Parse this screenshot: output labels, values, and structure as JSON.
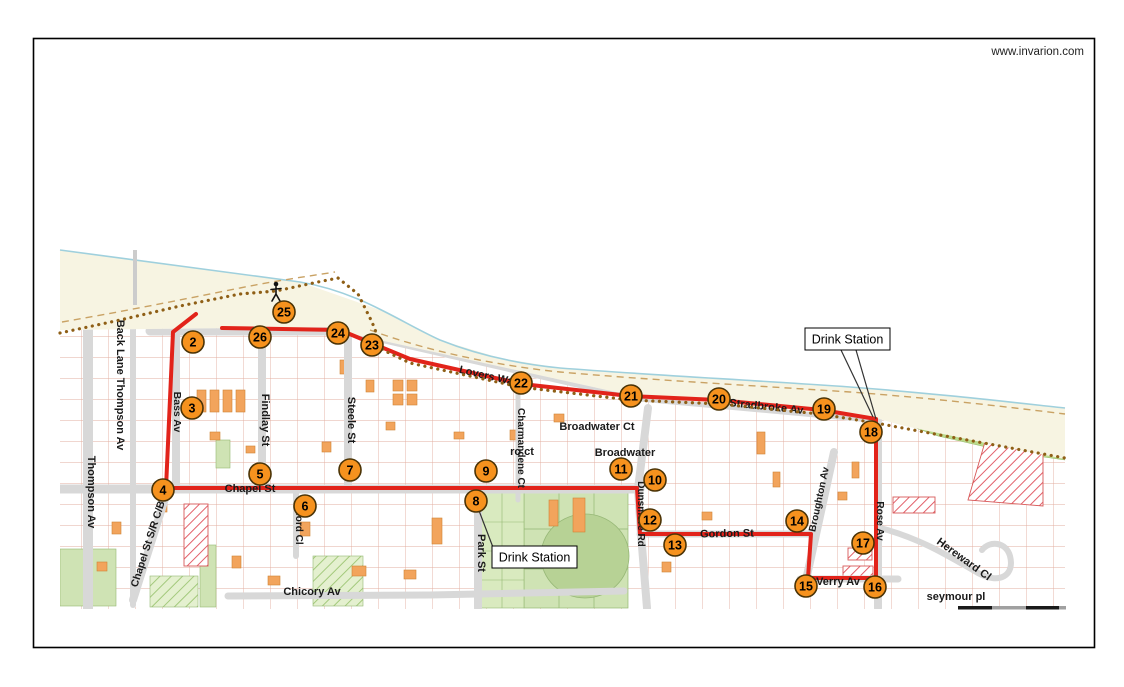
{
  "page": {
    "watermark": "www.invarion.com"
  },
  "colors": {
    "route": "#e2231a",
    "marker_fill": "#f6921e",
    "marker_ring": "#4a3306",
    "street": "#d8d8d8",
    "beach": "#f7f4e2",
    "coast_line": "#9fd0dd",
    "dune_line": "#c9a264",
    "trail": "#8f5f16",
    "green": "#cfe3b4",
    "green_band": "#bcdb8d",
    "oval": "#b7d295"
  },
  "map": {
    "markers": [
      {
        "n": "2",
        "x": 193,
        "y": 342
      },
      {
        "n": "3",
        "x": 192,
        "y": 408
      },
      {
        "n": "4",
        "x": 163,
        "y": 490
      },
      {
        "n": "5",
        "x": 260,
        "y": 474
      },
      {
        "n": "6",
        "x": 305,
        "y": 506
      },
      {
        "n": "7",
        "x": 350,
        "y": 470
      },
      {
        "n": "8",
        "x": 476,
        "y": 501
      },
      {
        "n": "9",
        "x": 486,
        "y": 471
      },
      {
        "n": "10",
        "x": 655,
        "y": 480
      },
      {
        "n": "11",
        "x": 621,
        "y": 469
      },
      {
        "n": "12",
        "x": 650,
        "y": 520
      },
      {
        "n": "13",
        "x": 675,
        "y": 545
      },
      {
        "n": "14",
        "x": 797,
        "y": 521
      },
      {
        "n": "15",
        "x": 806,
        "y": 586
      },
      {
        "n": "16",
        "x": 875,
        "y": 587
      },
      {
        "n": "17",
        "x": 863,
        "y": 543
      },
      {
        "n": "18",
        "x": 871,
        "y": 432
      },
      {
        "n": "19",
        "x": 824,
        "y": 409
      },
      {
        "n": "20",
        "x": 719,
        "y": 399
      },
      {
        "n": "21",
        "x": 631,
        "y": 396
      },
      {
        "n": "22",
        "x": 521,
        "y": 383
      },
      {
        "n": "23",
        "x": 372,
        "y": 345
      },
      {
        "n": "24",
        "x": 338,
        "y": 333
      },
      {
        "n": "25",
        "x": 284,
        "y": 312
      },
      {
        "n": "26",
        "x": 260,
        "y": 337
      }
    ],
    "street_labels": [
      {
        "slug": "back-lane-thompson-av",
        "text": "Back Lane Thompson Av",
        "x": 117,
        "y": 385,
        "rot": 90,
        "size": 11
      },
      {
        "slug": "thompson-av",
        "text": "Thompson Av",
        "x": 88,
        "y": 492,
        "rot": 90,
        "size": 11
      },
      {
        "slug": "bass-av",
        "text": "Bass Av",
        "x": 174,
        "y": 412,
        "rot": 90,
        "size": 10.5
      },
      {
        "slug": "findlay-st",
        "text": "Findlay St",
        "x": 262,
        "y": 420,
        "rot": 90,
        "size": 11
      },
      {
        "slug": "steele-st",
        "text": "Steele St",
        "x": 348,
        "y": 420,
        "rot": 90,
        "size": 11
      },
      {
        "slug": "chapel-st-srcb",
        "text": "Chapel St S/R C/B",
        "x": 151,
        "y": 545,
        "rot": -72,
        "size": 10.5
      },
      {
        "slug": "elsford-cl",
        "text": "Elsford Cl",
        "x": 296,
        "y": 521,
        "rot": 90,
        "size": 10
      },
      {
        "slug": "chapel-st",
        "text": "Chapel St",
        "x": 250,
        "y": 492,
        "rot": 0,
        "size": 11
      },
      {
        "slug": "chicory-av",
        "text": "Chicory Av",
        "x": 312,
        "y": 595,
        "rot": 0,
        "size": 11
      },
      {
        "slug": "park-st",
        "text": "Park St",
        "x": 478,
        "y": 553,
        "rot": 90,
        "size": 11
      },
      {
        "slug": "charmandene-ct",
        "text": "Charmandene Ct",
        "x": 518,
        "y": 448,
        "rot": 90,
        "size": 10
      },
      {
        "slug": "ro-ct",
        "text": "ro ct",
        "x": 522,
        "y": 455,
        "rot": 0,
        "size": 11
      },
      {
        "slug": "broadwater-ct",
        "text": "Broadwater Ct",
        "x": 597,
        "y": 430,
        "rot": 0,
        "size": 11
      },
      {
        "slug": "broadwater",
        "text": "Broadwater",
        "x": 625,
        "y": 456,
        "rot": 0,
        "size": 11
      },
      {
        "slug": "dunsmore-rd",
        "text": "Dunsmore Rd",
        "x": 638,
        "y": 514,
        "rot": 90,
        "size": 10
      },
      {
        "slug": "gordon-st",
        "text": "Gordon St",
        "x": 727,
        "y": 537,
        "rot": -1,
        "size": 11
      },
      {
        "slug": "broughton-av",
        "text": "Broughton Av",
        "x": 822,
        "y": 500,
        "rot": -78,
        "size": 10
      },
      {
        "slug": "verry-av",
        "text": "Verry Av",
        "x": 838,
        "y": 585,
        "rot": 0,
        "size": 11
      },
      {
        "slug": "rose-av",
        "text": "Rose Av",
        "x": 877,
        "y": 521,
        "rot": 90,
        "size": 10
      },
      {
        "slug": "stradbroke-av",
        "text": "Stradbroke Av",
        "x": 766,
        "y": 410,
        "rot": 6,
        "size": 11
      },
      {
        "slug": "lovers-walk",
        "text": "Lovers Walk",
        "x": 490,
        "y": 380,
        "rot": 13,
        "size": 11
      },
      {
        "slug": "hereward-cl",
        "text": "Hereward Cl",
        "x": 962,
        "y": 562,
        "rot": 36,
        "size": 11
      },
      {
        "slug": "seymour-pl",
        "text": "seymour pl",
        "x": 956,
        "y": 600,
        "rot": 0,
        "size": 11
      }
    ],
    "callouts": [
      {
        "slug": "drink-station-north",
        "text": "Drink Station",
        "box": {
          "x": 805,
          "y": 328,
          "w": 85,
          "h": 22
        },
        "lines": [
          [
            841,
            350,
            873,
            417
          ],
          [
            856,
            350,
            876,
            419
          ]
        ]
      },
      {
        "slug": "drink-station-south",
        "text": "Drink Station",
        "box": {
          "x": 492,
          "y": 546,
          "w": 85,
          "h": 22
        },
        "lines": [
          [
            478,
            508,
            494,
            550
          ]
        ]
      }
    ],
    "route": {
      "width": 4,
      "points": [
        [
          222,
          328
        ],
        [
          340,
          330
        ],
        [
          352,
          335
        ],
        [
          410,
          359
        ],
        [
          522,
          384
        ],
        [
          630,
          396
        ],
        [
          718,
          400
        ],
        [
          822,
          410
        ],
        [
          876,
          419
        ],
        [
          876,
          578
        ],
        [
          808,
          578
        ],
        [
          811,
          534
        ],
        [
          640,
          534
        ],
        [
          637,
          488
        ],
        [
          166,
          488
        ],
        [
          173,
          332
        ],
        [
          196,
          314
        ]
      ]
    },
    "trail": {
      "points": [
        [
          60,
          333
        ],
        [
          120,
          320
        ],
        [
          180,
          306
        ],
        [
          240,
          294
        ],
        [
          276,
          291
        ],
        [
          318,
          282
        ],
        [
          338,
          278
        ],
        [
          358,
          294
        ],
        [
          372,
          322
        ],
        [
          383,
          350
        ],
        [
          410,
          363
        ],
        [
          520,
          387
        ],
        [
          630,
          400
        ],
        [
          720,
          404
        ],
        [
          820,
          414
        ],
        [
          876,
          423
        ],
        [
          940,
          435
        ],
        [
          1000,
          446
        ],
        [
          1065,
          458
        ]
      ]
    },
    "walker": {
      "x": 276,
      "y": 291
    },
    "scale_bar": {
      "x": 958,
      "y": 606,
      "h": 3.5,
      "segments": [
        {
          "color": "#1a1a1a",
          "w": 34
        },
        {
          "color": "#a0a0a0",
          "w": 34
        },
        {
          "color": "#1a1a1a",
          "w": 33
        },
        {
          "color": "#a0a0a0",
          "w": 7
        }
      ]
    }
  }
}
